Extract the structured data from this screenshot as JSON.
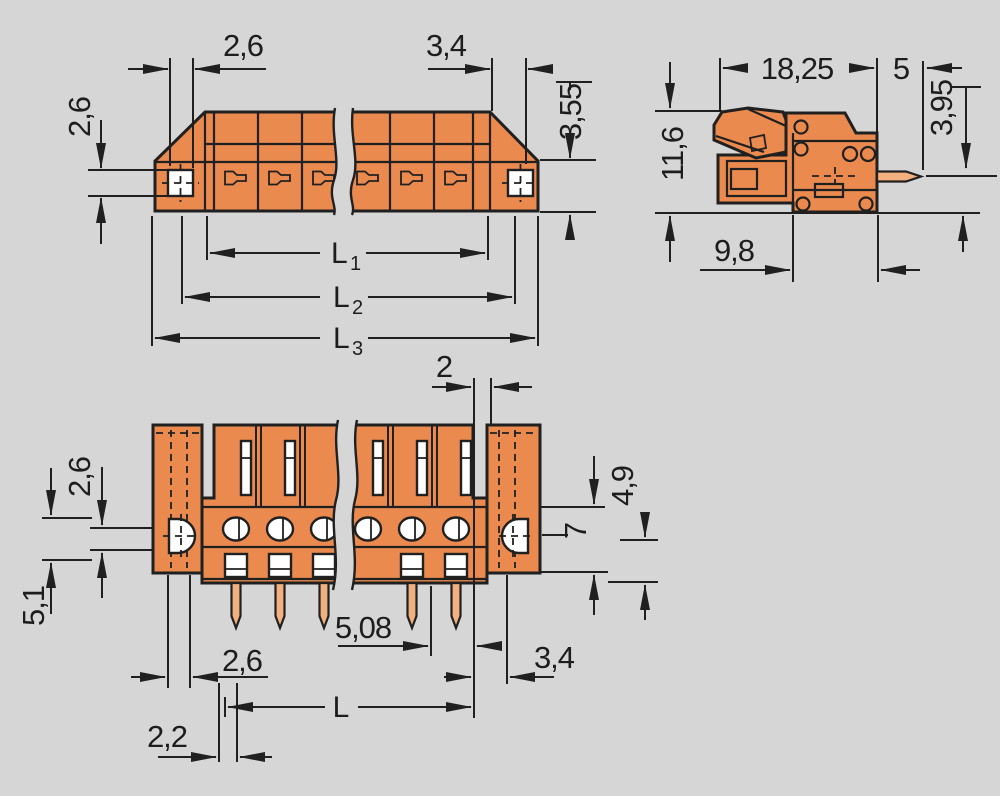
{
  "drawing_title": "terminal-block-dimension-drawing",
  "colors": {
    "background": "#d5d6d5",
    "body_orange": "#ea8a4e",
    "pin_tan": "#f1b07e",
    "line": "#202020",
    "hole_white": "#ffffff"
  },
  "dimensions": {
    "top_view": {
      "square_width": "2,6",
      "right_width": "3,4",
      "square_height": "2,6",
      "right_height": "3,55",
      "l1": {
        "base": "L",
        "sub": "1"
      },
      "l2": {
        "base": "L",
        "sub": "2"
      },
      "l3": {
        "base": "L",
        "sub": "3"
      }
    },
    "side_view": {
      "depth": "18,25",
      "pin_length": "5",
      "pin_offset": "3,95",
      "height": "11,6",
      "flange_depth": "9,8"
    },
    "front_view": {
      "gap": "2",
      "hole_height": "2,6",
      "flange_span": "5,1",
      "lower_height": "4,9",
      "mid_height": "7",
      "pitch": "5,08",
      "hole_width": "2,6",
      "right_margin": "3,4",
      "length": "L",
      "pin_offset": "2,2"
    }
  }
}
